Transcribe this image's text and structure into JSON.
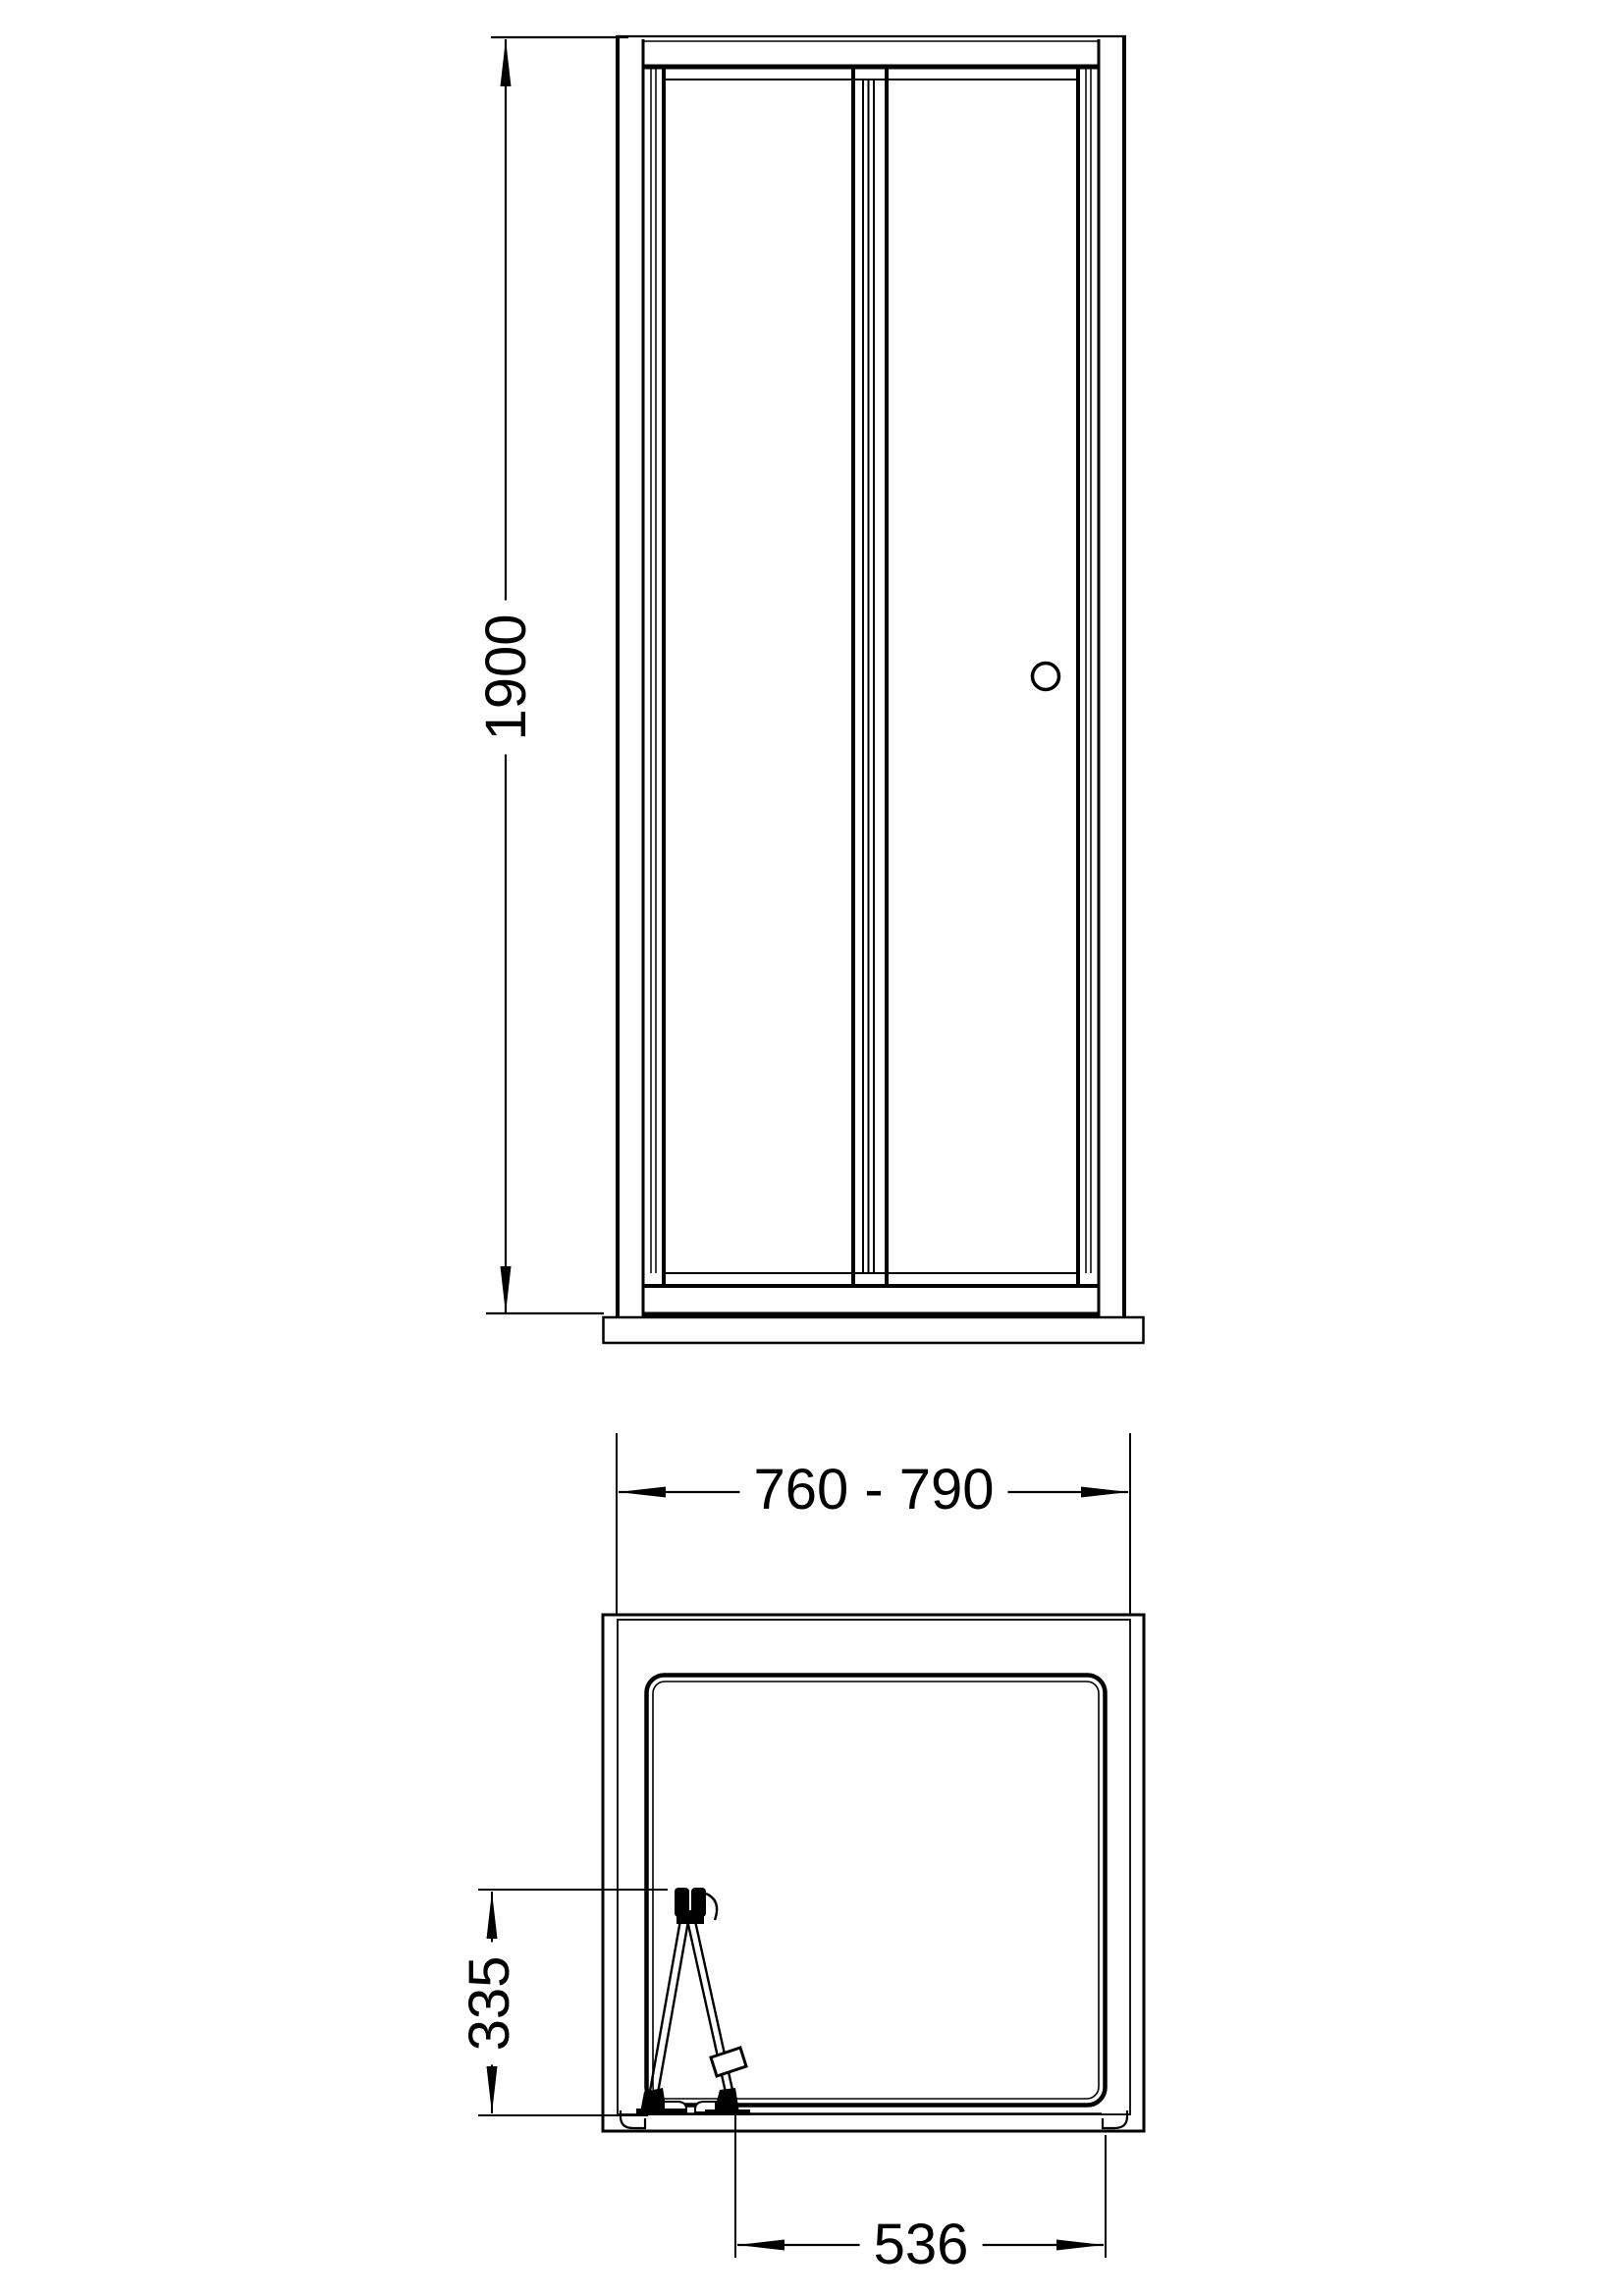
{
  "drawing": {
    "background": "#ffffff",
    "line_color": "#000000",
    "dimensions": {
      "height": "1900",
      "width_range": "760 - 790",
      "door_projection_depth": "335",
      "opening_width": "536"
    }
  }
}
